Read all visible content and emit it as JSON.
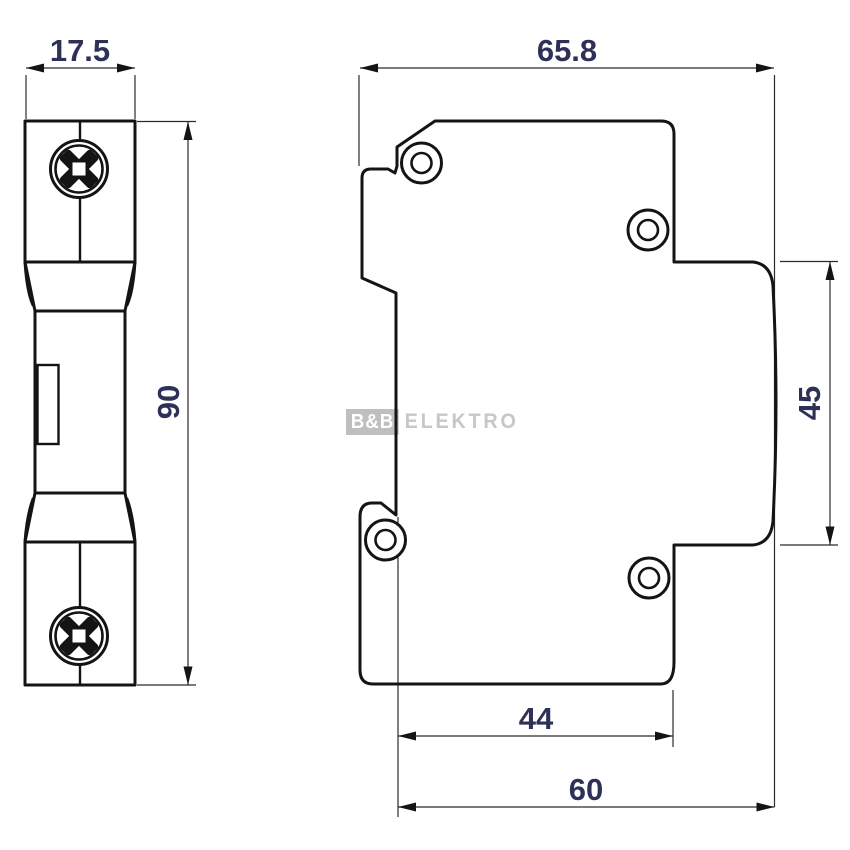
{
  "drawing": {
    "front_view": {
      "width_dim": "17.5",
      "height_dim": "90"
    },
    "side_view": {
      "overall_depth_dim": "65.8",
      "front_face_height_dim": "45",
      "body_depth_dim": "44",
      "depth_to_front_dim": "60"
    },
    "watermark": {
      "brand": "B&B",
      "suffix": "ELEKTRO"
    },
    "colors": {
      "line": "#141414",
      "dimension_text": "#2d3157",
      "watermark_gray": "#c7c7c7"
    }
  }
}
